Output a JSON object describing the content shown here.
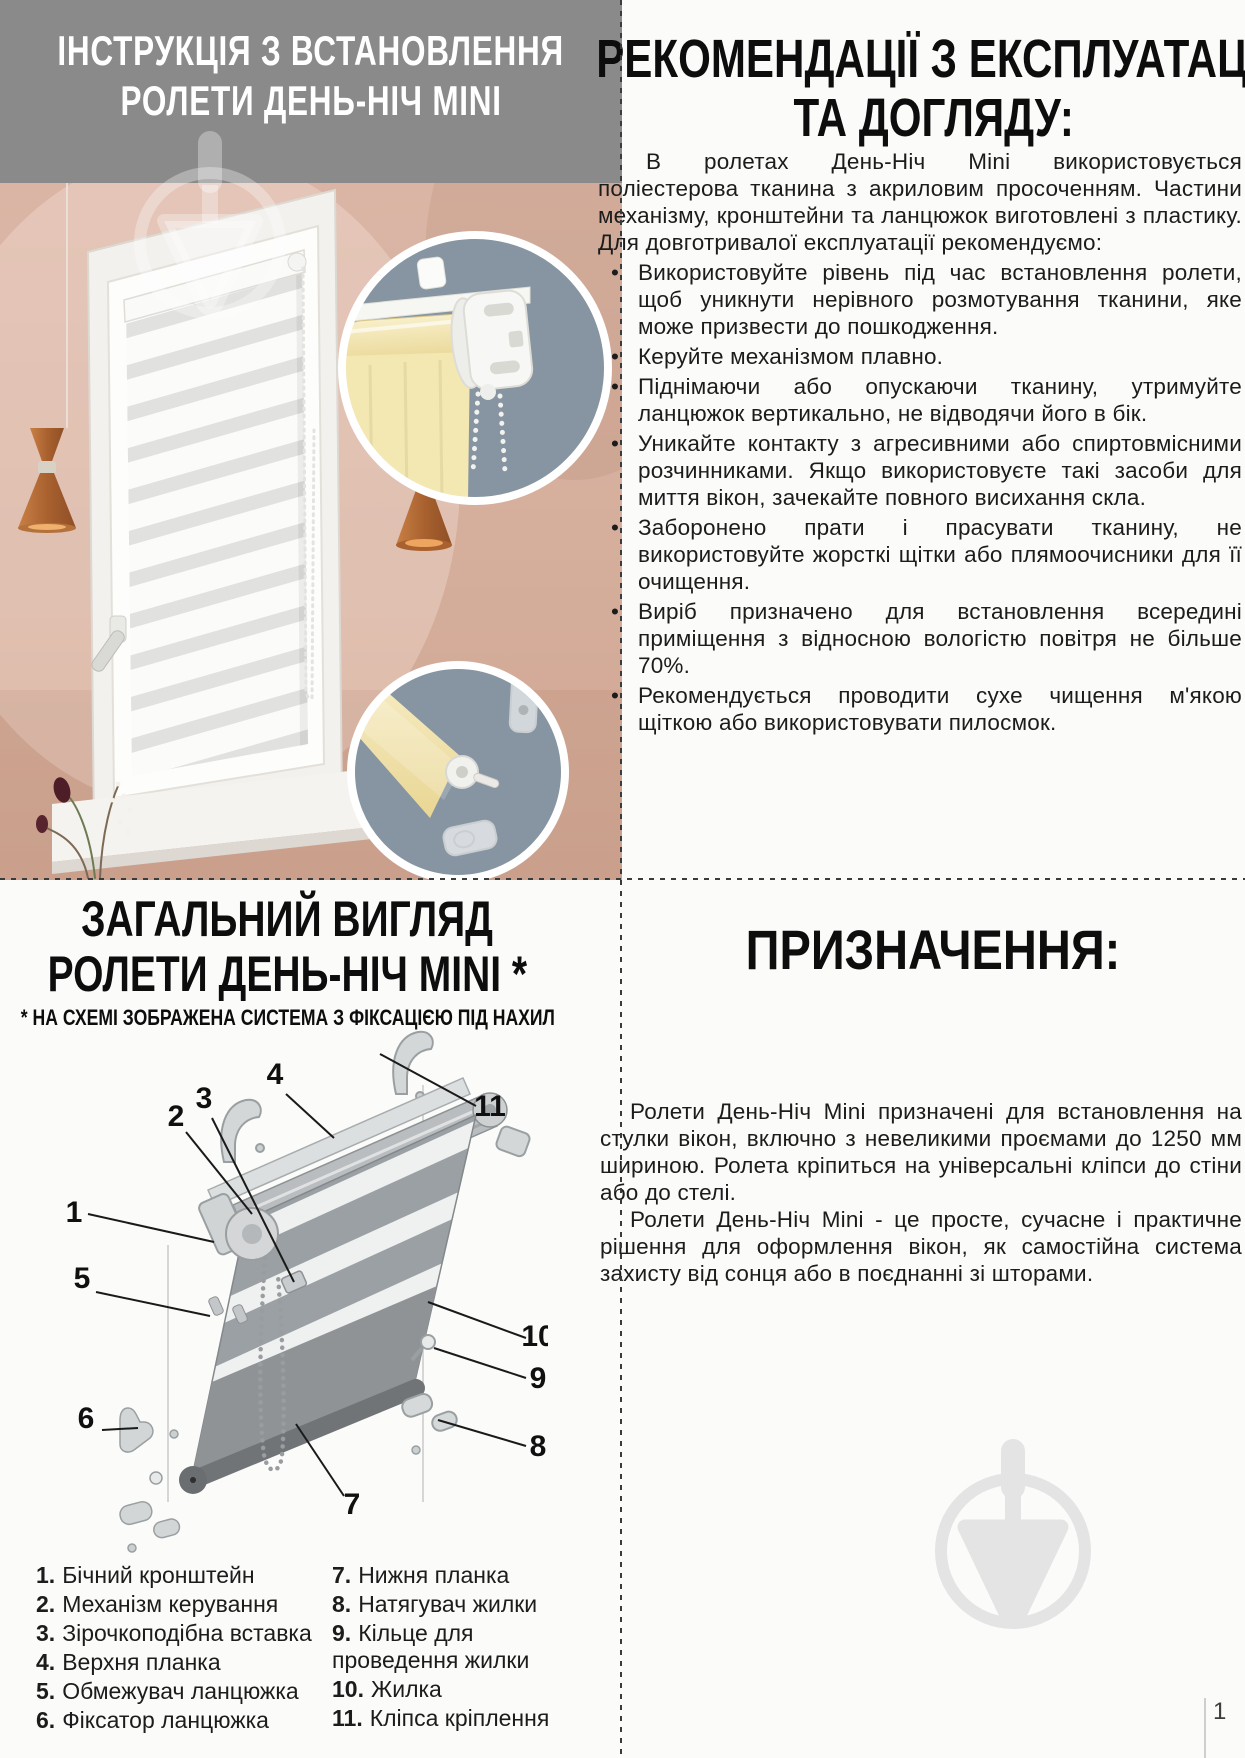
{
  "top_left": {
    "title_line1": "ІНСТРУКЦІЯ З ВСТАНОВЛЕННЯ",
    "title_line2": "РОЛЕТИ ДЕНЬ-НІЧ MINI"
  },
  "recommendations": {
    "title_line1": "РЕКОМЕНДАЦІЇ З ЕКСПЛУАТАЦІЇ",
    "title_line2": "ТА ДОГЛЯДУ:",
    "intro": "В ролетах День-Ніч Mini використовується поліестерова тканина з акриловим просоченням. Частини механізму, кронштейни та ланцюжок виготовлені з пластику. Для довготривалої експлуатації рекомендуємо:",
    "bullets": [
      "Використовуйте рівень під час встановлення ролети, щоб уникнути нерівного розмотування тканини, яке може призвести до пошкодження.",
      "Керуйте механізмом плавно.",
      "Піднімаючи або опускаючи тканину, утримуйте ланцюжок вертикально, не відводячи його в бік.",
      "Уникайте контакту з агресивними або спиртовмісними розчинниками. Якщо використовуєте такі засоби для миття вікон, зачекайте повного висихання скла.",
      "Заборонено прати і прасувати тканину, не використовуйте жорсткі щітки або плямоочисники для її очищення.",
      "Виріб призначено для встановлення всередині приміщення з відносною вологістю повітря не більше 70%.",
      "Рекомендується проводити сухе чищення м'якою щіткою або використовувати пилосмок."
    ]
  },
  "overview": {
    "title_line1": "ЗАГАЛЬНИЙ ВИГЛЯД",
    "title_line2": "РОЛЕТИ ДЕНЬ-НІЧ MINI *",
    "note": "* НА СХЕМІ ЗОБРАЖЕНА СИСТЕМА З ФІКСАЦІЄЮ ПІД НАХИЛ",
    "callouts": [
      "1",
      "2",
      "3",
      "4",
      "5",
      "6",
      "7",
      "8",
      "9",
      "10",
      "11"
    ],
    "legend_left": [
      {
        "num": "1.",
        "label": "Бічний кронштейн"
      },
      {
        "num": "2.",
        "label": "Механізм керування"
      },
      {
        "num": "3.",
        "label": "Зірочкоподібна вставка"
      },
      {
        "num": "4.",
        "label": "Верхня планка"
      },
      {
        "num": "5.",
        "label": "Обмежувач ланцюжка"
      },
      {
        "num": "6.",
        "label": "Фіксатор ланцюжка"
      }
    ],
    "legend_right": [
      {
        "num": "7.",
        "label": "Нижня планка"
      },
      {
        "num": "8.",
        "label": "Натягувач жилки"
      },
      {
        "num": "9.",
        "label": "Кільце для проведення жилки"
      },
      {
        "num": "10.",
        "label": "Жилка"
      },
      {
        "num": "11.",
        "label": "Кліпса кріплення"
      }
    ]
  },
  "purpose": {
    "title": "ПРИЗНАЧЕННЯ:",
    "p1": "Ролети День-Ніч Mini призначені для встановлення на стулки вікон, включно з невеликими проємами до 1250 мм шириною. Ролета кріпиться на універсальні кліпси до стіни або до стелі.",
    "p2": "Ролети День-Ніч Mini - це просте, сучасне і практичне рішення для оформлення вікон, як самостійна система захисту від сонця або в поєднанні зі шторами."
  },
  "page": {
    "number": "1"
  },
  "colors": {
    "header_gray": "#8A8A8A",
    "wall_pink": "#D8B2A3",
    "inset_slate": "#8695A1",
    "fabric_yellow": "#F2E3AC",
    "copper_lamp": "#B96F3F",
    "watermark_gray": "#E4E4E4"
  }
}
